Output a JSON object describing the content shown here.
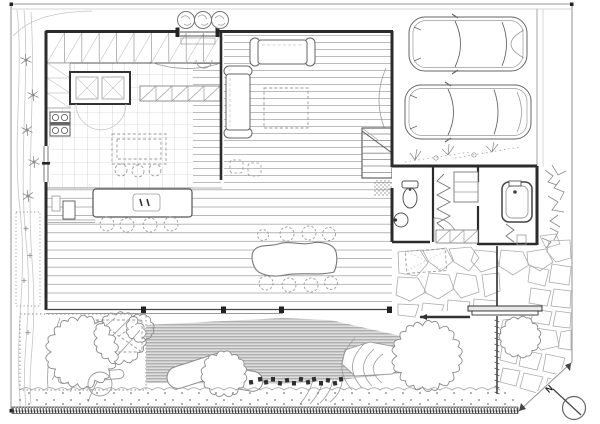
{
  "page": {
    "title": "Residential ground-floor plan",
    "kind": "black-and-white architectural CAD line drawing"
  },
  "compass": {
    "label": "N"
  },
  "palette": {
    "background": "#ffffff",
    "wall": "#2b2b2b",
    "line": "#555555",
    "line_light": "#9a9a9a",
    "line_faint": "#c6c6c6",
    "water_line": "#9c9c9c",
    "water_bg": "#dedede",
    "rock": "#2e2e2e"
  },
  "rooms": [
    {
      "name": "entry",
      "features": [
        "recessed door",
        "three round planters"
      ]
    },
    {
      "name": "kitchen",
      "features": [
        "tiled grid floor",
        "upper cabinets",
        "pantry box",
        "4-burner stove",
        "island with 3 stools"
      ]
    },
    {
      "name": "living-room",
      "features": [
        "plank floor",
        "L-shaped sofa",
        "dashed rug",
        "staircase"
      ]
    },
    {
      "name": "dining-hall",
      "features": [
        "wide plank floor",
        "long counter with 4 stools",
        "organic slab dining table with 8 chairs",
        "full-width south glazing"
      ]
    },
    {
      "name": "bathroom-block",
      "features": [
        "toilet",
        "wash basin",
        "closet with hanging rail",
        "shelves",
        "bathtub"
      ]
    },
    {
      "name": "carport",
      "features": [
        "two cars parked side by side",
        "weed sketches"
      ]
    },
    {
      "name": "stone-courtyard",
      "features": [
        "irregular flagstone paving",
        "garden gate",
        "fence"
      ]
    },
    {
      "name": "garden",
      "features": [
        "scalloped trees and shrubs",
        "planting bed",
        "water feature band",
        "white boulder",
        "stepping rocks",
        "gravel strip",
        "contour lines"
      ]
    }
  ],
  "objects": [
    {
      "name": "car-1",
      "type": "sports car, top view"
    },
    {
      "name": "car-2",
      "type": "sedan, top view"
    },
    {
      "name": "dining-table",
      "seats": 8
    },
    {
      "name": "counter",
      "stools": 4
    },
    {
      "name": "kitchen-island",
      "stools": 3
    },
    {
      "name": "sofa-l-shaped"
    },
    {
      "name": "stove-4-burner"
    },
    {
      "name": "toilet"
    },
    {
      "name": "wash-basin"
    },
    {
      "name": "bathtub"
    },
    {
      "name": "boulder"
    },
    {
      "name": "stepping-rocks"
    },
    {
      "name": "entry-planters",
      "count": 3
    },
    {
      "name": "north-arrow"
    }
  ]
}
